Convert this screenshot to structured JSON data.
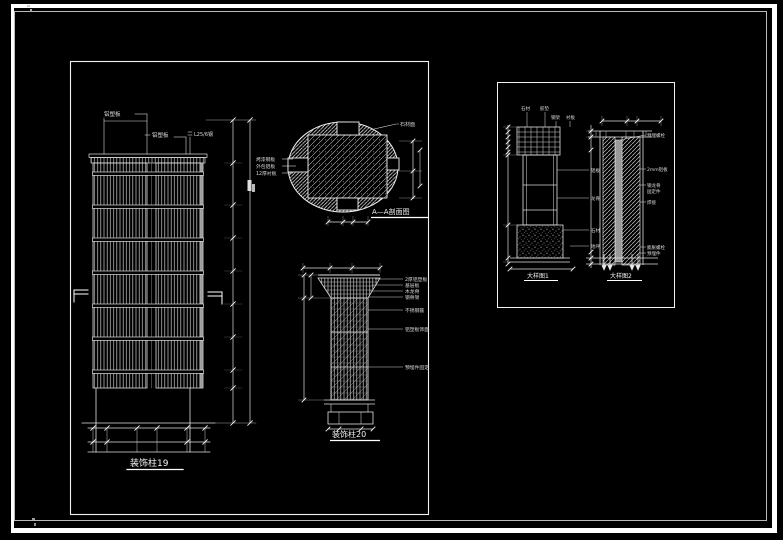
{
  "sheet": {
    "background_color": "#000000",
    "line_color": "#ffffff"
  },
  "drawings": {
    "column19": {
      "title": "装饰柱19",
      "label_top1": "铝塑板",
      "label_top2": "铝塑板",
      "label_top3": "L25/6钢"
    },
    "section_aa": {
      "title": "A—A剖面图",
      "left_labels": [
        "烤漆钢板",
        "外包铝板",
        "12厚衬板"
      ],
      "top_right_label": "石材面"
    },
    "column20": {
      "title": "装饰柱20",
      "leaders": [
        "2厚铝塑板",
        "基层板",
        "木龙骨",
        "钢骨架",
        "不锈钢箍",
        "铝塑板饰面",
        "预埋件固定"
      ]
    },
    "detail1": {
      "title": "大样图1",
      "top_labels": [
        "石材",
        "胶垫",
        "钢架",
        "衬板"
      ],
      "right_labels": [
        "铝板",
        "龙骨",
        "石材",
        "地坪"
      ]
    },
    "detail2": {
      "title": "大样图2",
      "top_right_label": "预埋螺栓",
      "right_labels": [
        "2mm铝板",
        "钢龙骨",
        "固定件",
        "焊接",
        "膨胀螺栓",
        "预埋件"
      ]
    }
  }
}
